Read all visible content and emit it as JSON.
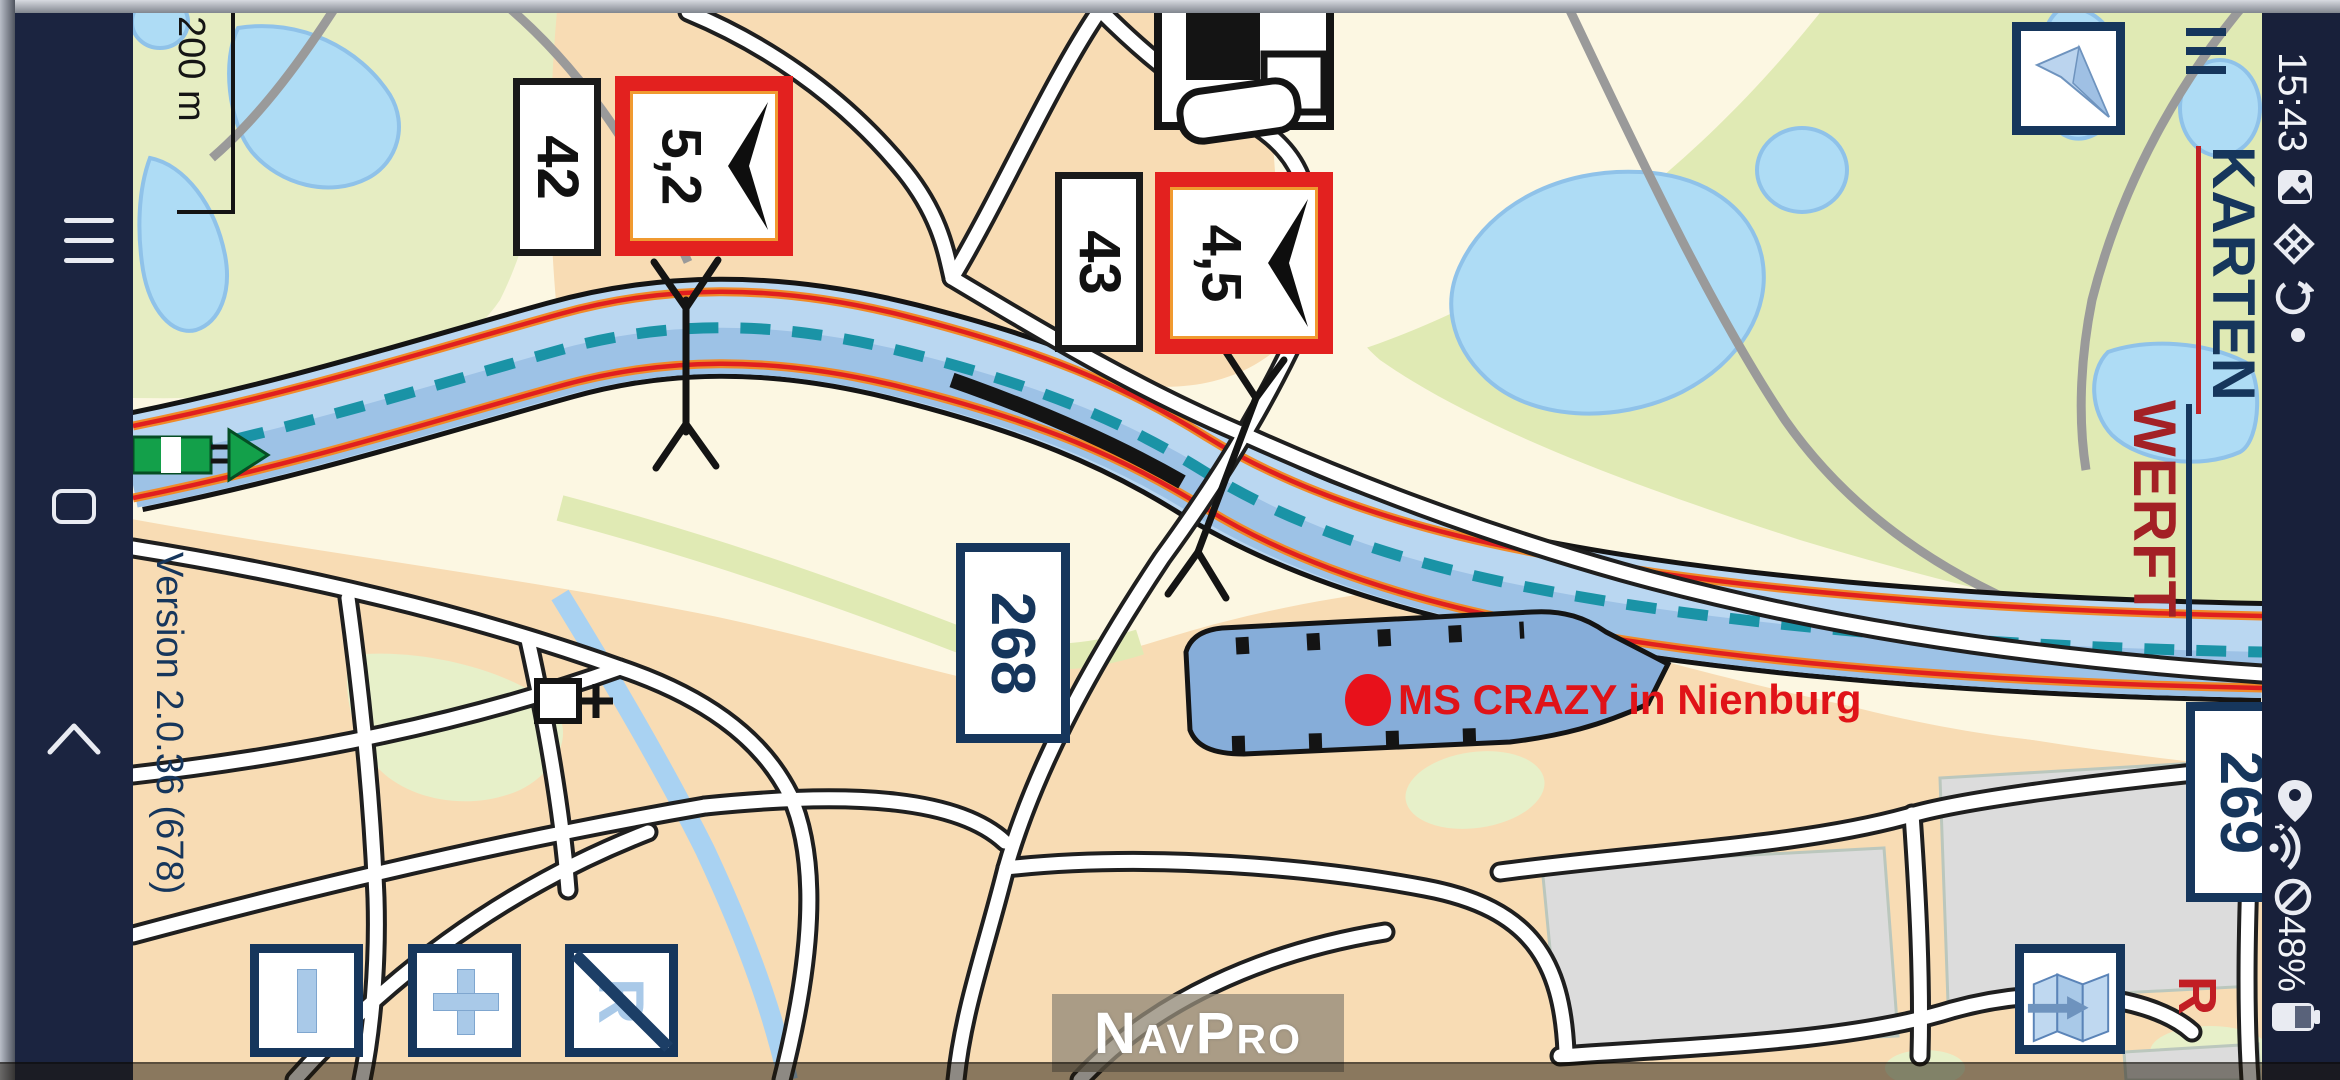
{
  "app": {
    "name": "NavPro",
    "version_label": "Version 2.0.36 (678)"
  },
  "scale": {
    "label": "200 m"
  },
  "marker": {
    "label": "MS CRAZY in Nienburg"
  },
  "signs": {
    "km_42": "42",
    "km_43": "43",
    "hm_52": "5,2",
    "hm_45": "4,5",
    "wp_268": "268",
    "wp_269": "269"
  },
  "logo": {
    "top": "KARTEN",
    "bottom": "WERFT"
  },
  "status": {
    "time": "15:43",
    "battery": "48%"
  },
  "buttons": {
    "record_letter": "R"
  },
  "map_letters": {
    "route_letter": "R"
  },
  "icons": {
    "nav_bar": [
      "menu-icon",
      "home-icon",
      "back-icon"
    ],
    "status_bar": [
      "screenshot-icon",
      "no-data-icon",
      "sync-icon",
      "location-icon",
      "wifi-icon",
      "dnd-icon",
      "battery-icon"
    ],
    "map_controls": [
      "zoom-out-icon",
      "zoom-in-icon",
      "record-off-icon",
      "north-arrow-icon",
      "chart-select-icon",
      "menu-icon"
    ]
  },
  "colors": {
    "accent_red": "#E3211F",
    "navy": "#16365C",
    "water": "#BAD7F1",
    "harbor": "#86ADD9",
    "urban": "#F8DCB4",
    "fairway_dash": "#1A93A6",
    "status_bar_bg": "#18203A",
    "nav_bar_bg": "#1B2440"
  }
}
